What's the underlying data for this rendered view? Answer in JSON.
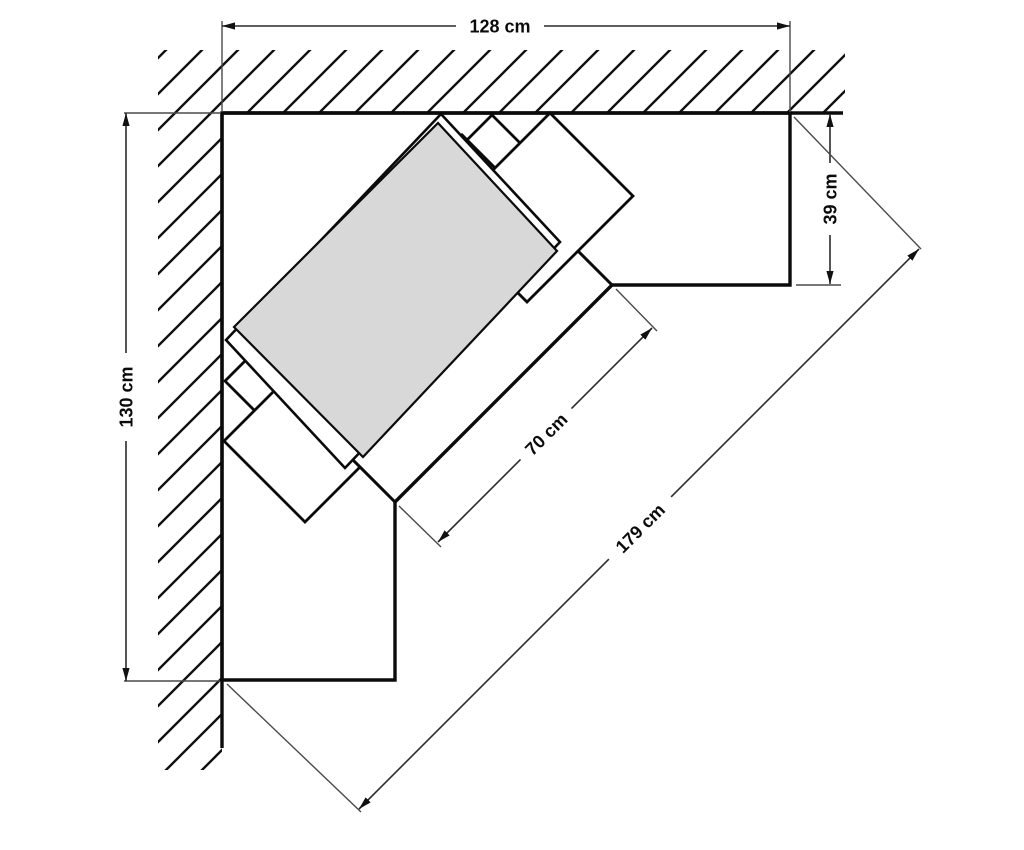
{
  "diagram": {
    "dimensions": {
      "top_width": {
        "label": "128 cm",
        "value": 128,
        "unit": "cm"
      },
      "left_height": {
        "label": "130 cm",
        "value": 130,
        "unit": "cm"
      },
      "side_depth": {
        "label": "39 cm",
        "value": 39,
        "unit": "cm"
      },
      "front_edge": {
        "label": "70 cm",
        "value": 70,
        "unit": "cm"
      },
      "diagonal": {
        "label": "179 cm",
        "value": 179,
        "unit": "cm"
      }
    },
    "colors": {
      "line": "#0b0b0b",
      "desktop_fill": "#d8d8d8",
      "background": "#ffffff"
    }
  }
}
